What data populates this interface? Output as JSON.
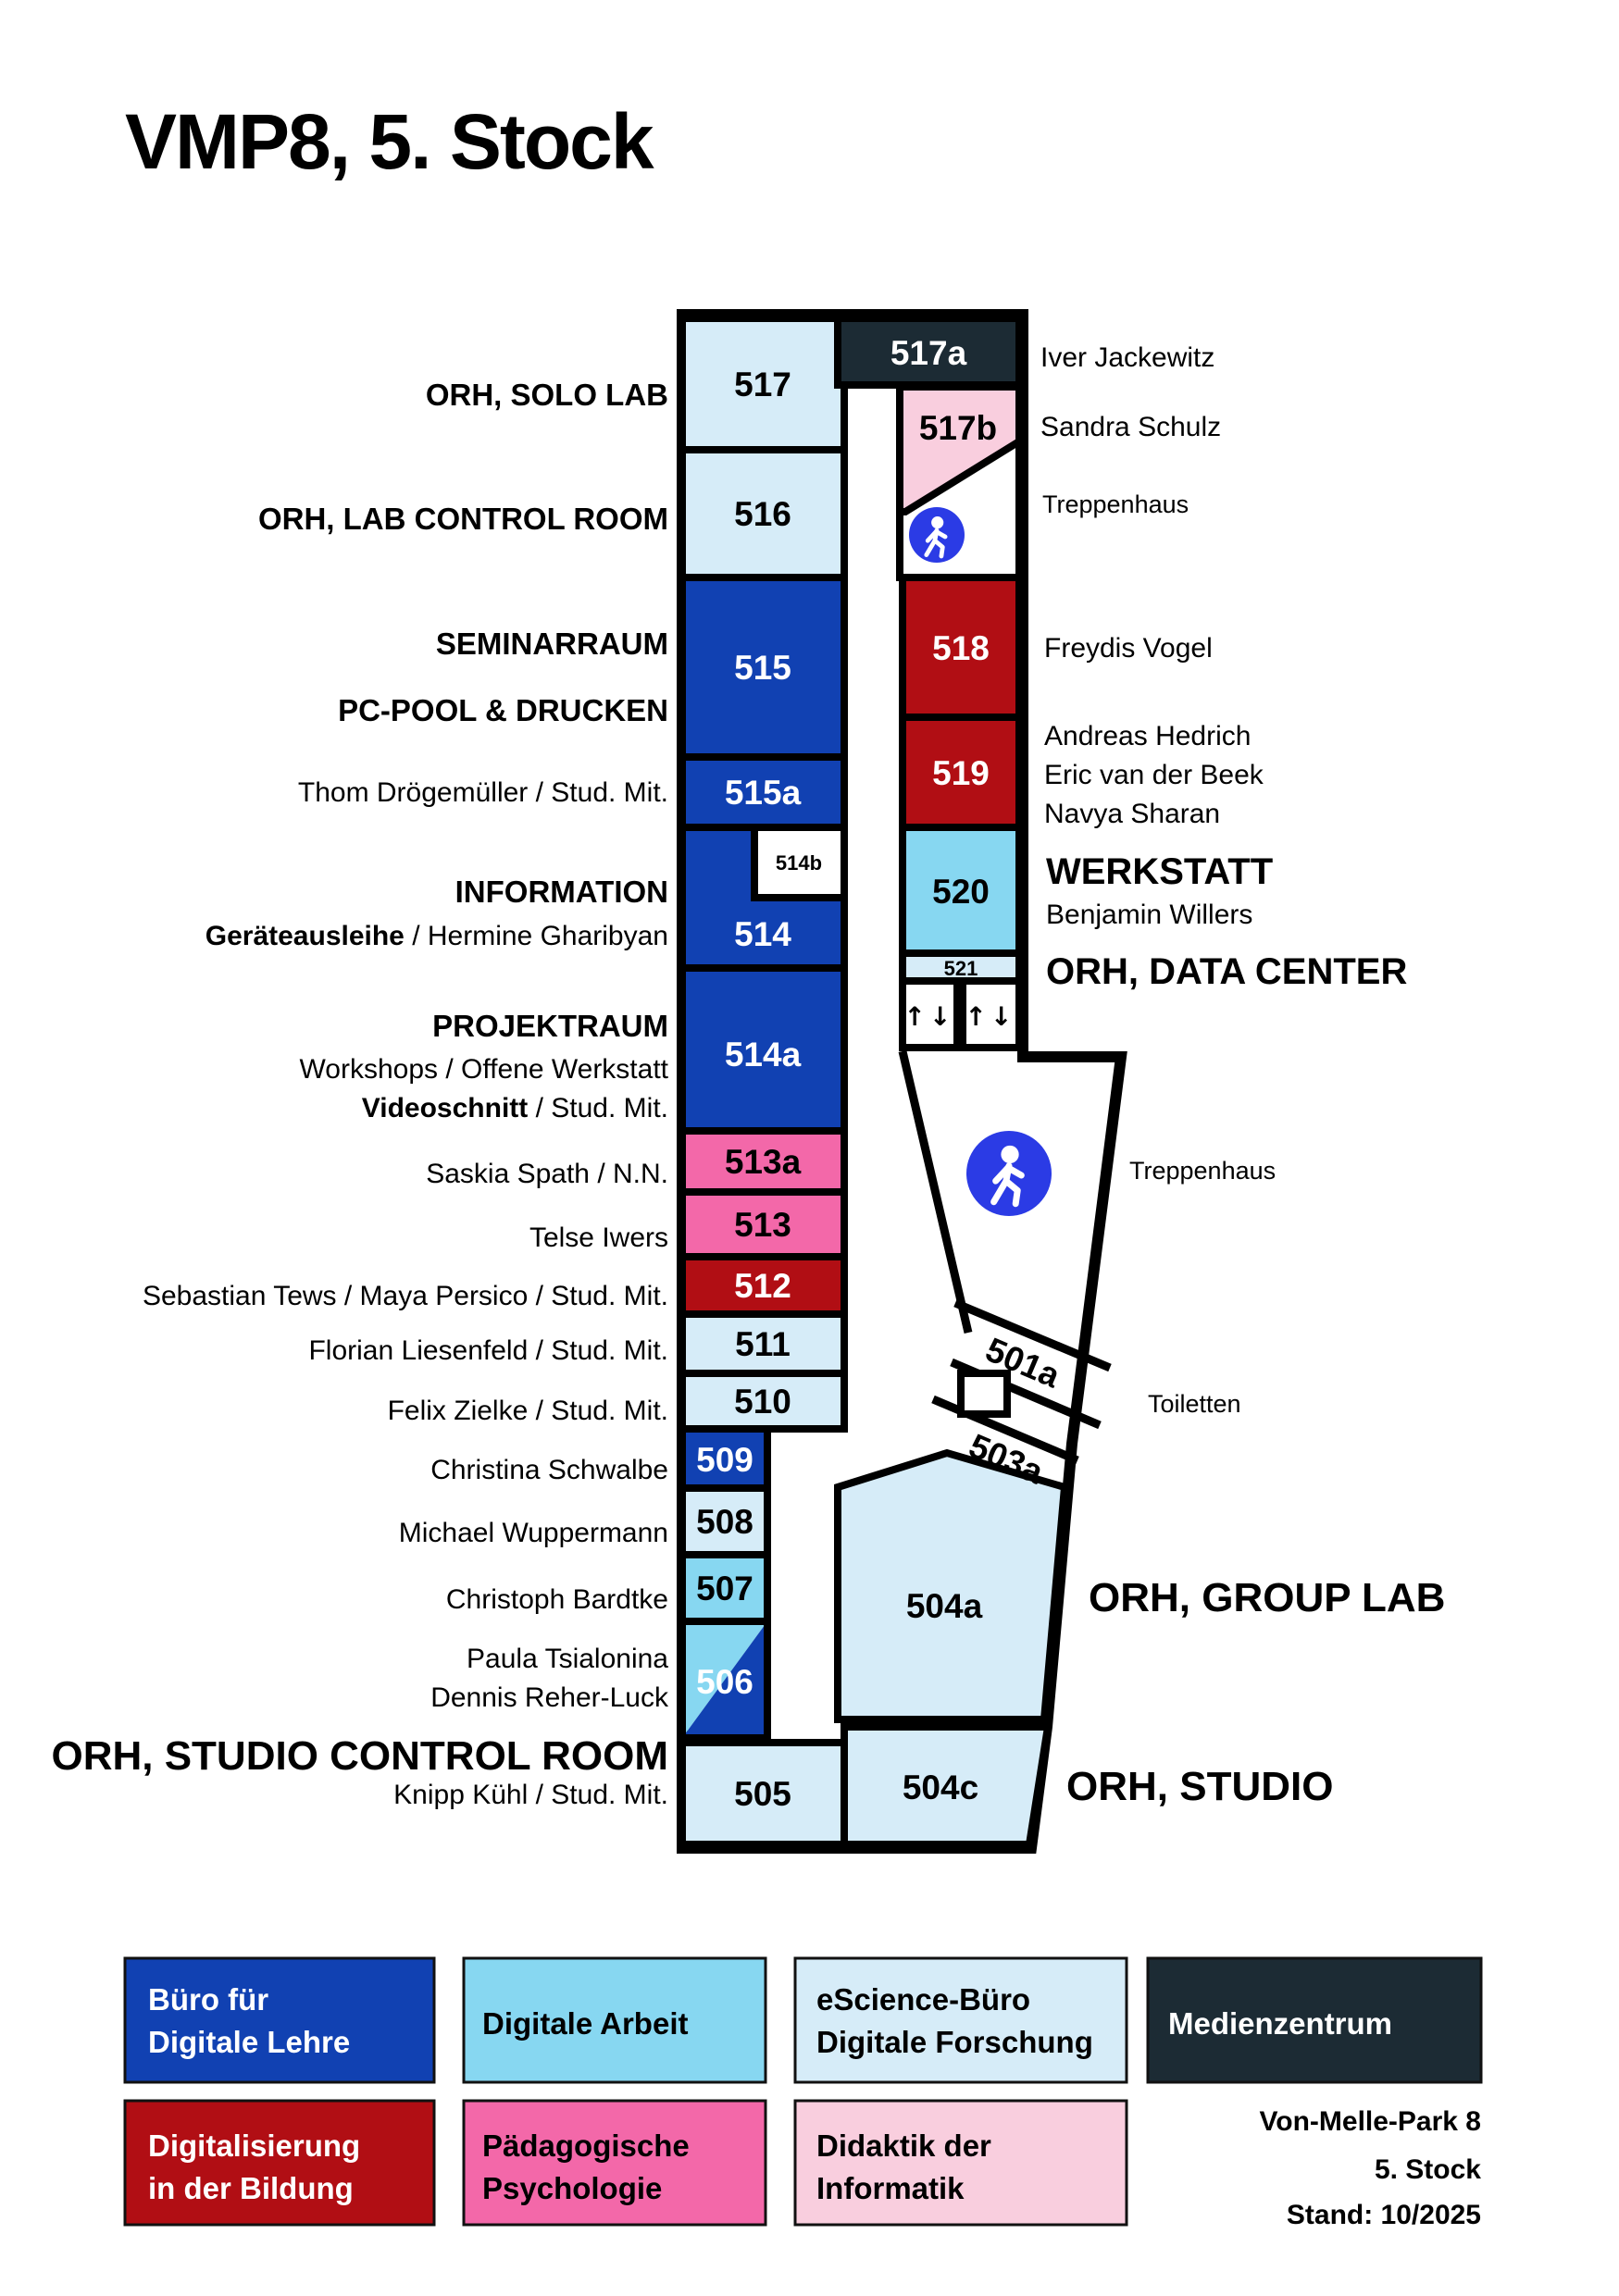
{
  "title": "VMP8, 5. Stock",
  "colors": {
    "blue": "#1141b2",
    "cyan": "#87d7f1",
    "lightblue": "#d6ecf8",
    "red": "#b10e14",
    "pink": "#f368a9",
    "lightpink": "#f9cede",
    "slate": "#1c2b34",
    "walkblue": "#2b3be5"
  },
  "rooms": {
    "r517": "517",
    "r516": "516",
    "r515": "515",
    "r515a": "515a",
    "r514": "514",
    "r514b": "514b",
    "r514a": "514a",
    "r513a": "513a",
    "r513": "513",
    "r512": "512",
    "r511": "511",
    "r510": "510",
    "r509": "509",
    "r508": "508",
    "r507": "507",
    "r506": "506",
    "r505": "505",
    "r517a": "517a",
    "r517b": "517b",
    "r518": "518",
    "r519": "519",
    "r520": "520",
    "r521": "521",
    "r501a": "501a",
    "r503a": "503a",
    "r504a": "504a",
    "r504c": "504c",
    "elevator": "↑↓"
  },
  "left_labels": {
    "solo_lab": "ORH, SOLO LAB",
    "lab_control": "ORH, LAB CONTROL ROOM",
    "seminarraum": "SEMINARRAUM",
    "pcpool": "PC-POOL & DRUCKEN",
    "thom": "Thom Drögemüller / Stud. Mit.",
    "information": "INFORMATION",
    "geraete_bold": "Geräteausleihe ",
    "geraete_rest": "/ Hermine Gharibyan",
    "projektraum": "PROJEKTRAUM",
    "workshops": "Workshops / Offene Werkstatt",
    "videoschnitt_bold": "Videoschnitt ",
    "videoschnitt_rest": "/ Stud. Mit.",
    "saskia": "Saskia Spath / N.N.",
    "telse": "Telse Iwers",
    "sebastian": "Sebastian Tews / Maya Persico / Stud. Mit.",
    "florian": "Florian Liesenfeld / Stud. Mit.",
    "felix": "Felix Zielke / Stud. Mit.",
    "christina": "Christina Schwalbe",
    "michael": "Michael Wuppermann",
    "christoph": "Christoph Bardtke",
    "paula": "Paula Tsialonina",
    "dennis": "Dennis Reher-Luck",
    "studio_control": "ORH, STUDIO CONTROL ROOM",
    "knipp": "Knipp Kühl / Stud. Mit."
  },
  "right_labels": {
    "iver": "Iver Jackewitz",
    "sandra": "Sandra Schulz",
    "treppenhaus_top": "Treppenhaus",
    "freydis": "Freydis Vogel",
    "andreas": "Andreas Hedrich",
    "eric": "Eric van der Beek",
    "navya": "Navya Sharan",
    "werkstatt": "WERKSTATT",
    "benjamin": "Benjamin Willers",
    "data_center": "ORH, DATA CENTER",
    "treppenhaus_mid": "Treppenhaus",
    "toiletten": "Toiletten",
    "group_lab": "ORH, GROUP LAB",
    "studio": "ORH, STUDIO"
  },
  "legend": {
    "buero_line1": "Büro für",
    "buero_line2": "Digitale Lehre",
    "arbeit": "Digitale Arbeit",
    "escience_line1": "eScience-Büro",
    "escience_line2": "Digitale Forschung",
    "medien": "Medienzentrum",
    "digi_line1": "Digitalisierung",
    "digi_line2": "in der Bildung",
    "paed_line1": "Pädagogische",
    "paed_line2": "Psychologie",
    "didaktik_line1": "Didaktik der",
    "didaktik_line2": "Informatik"
  },
  "footer": {
    "address": "Von-Melle-Park 8",
    "floor": "5. Stock",
    "stand": "Stand: 10/2025"
  }
}
